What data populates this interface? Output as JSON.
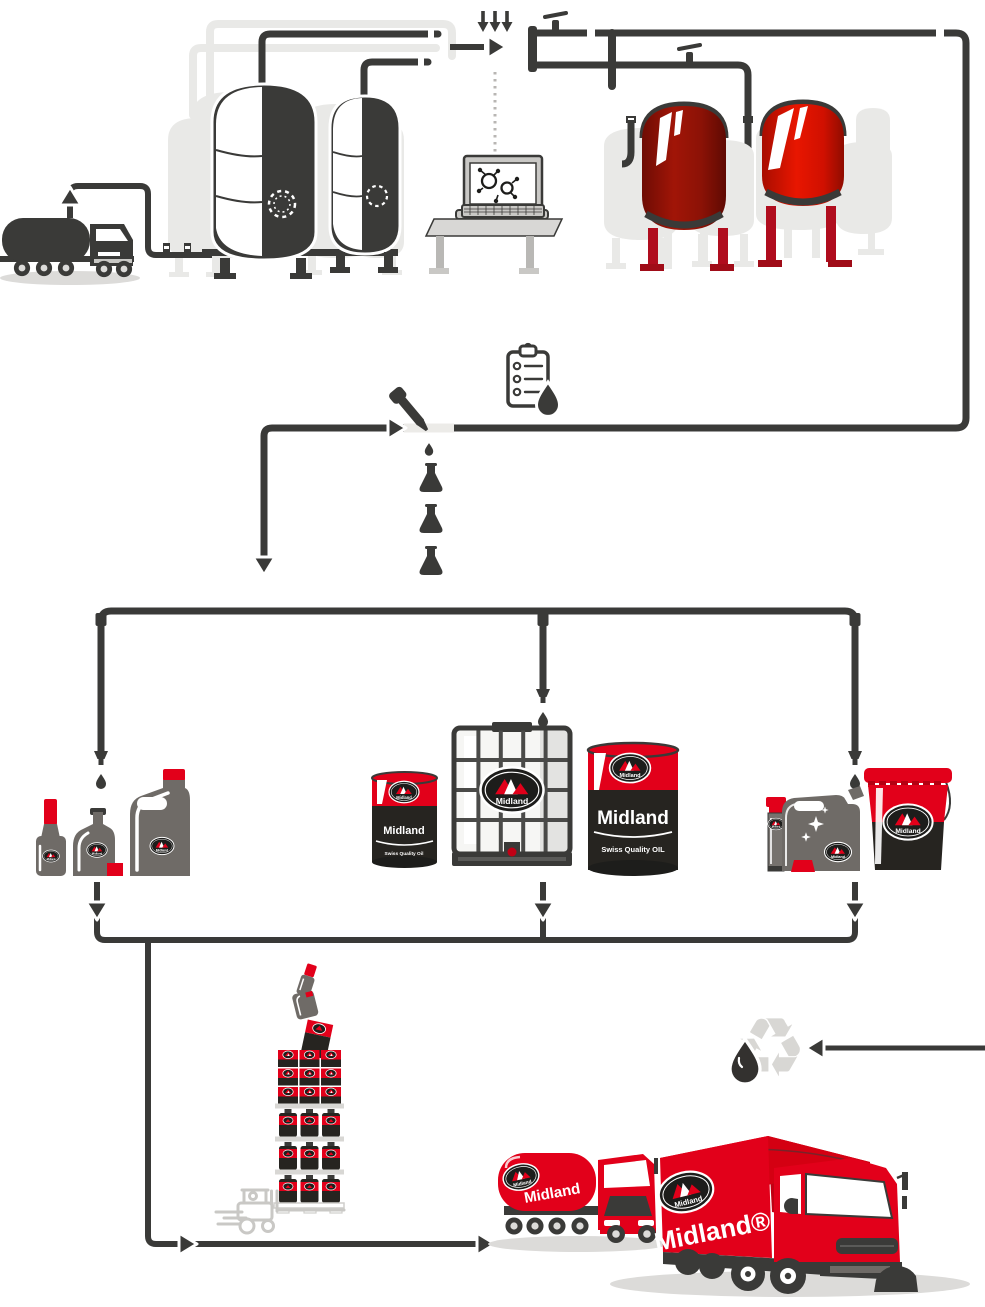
{
  "page": {
    "width": 985,
    "height": 1307,
    "background": "#ffffff"
  },
  "brand": {
    "logo_text": "Midland",
    "tagline": "Swiss Quality Oil"
  },
  "colors": {
    "red": "#e2001a",
    "dark_red": "#8f1406",
    "charcoal": "#3a3a38",
    "label_black": "#262420",
    "light_gray": "#e9e9e7",
    "container_gray": "#6f6b67",
    "pale_gray": "#c9c8c5",
    "shadow_gray": "#dcdbd9"
  },
  "labels": {
    "drum_small_brand": "Midland",
    "drum_small_tagline": "Swiss Quality Oil",
    "drum_large_brand": "Midland",
    "drum_large_tagline": "Swiss Quality OIL",
    "tanker_truck_brand": "Midland",
    "box_truck_brand": "Midland®"
  },
  "icons": {
    "recycle_glyph": "♻",
    "names": [
      "up-arrow-icon",
      "additive-arrows-icon",
      "flow-arrow-icon",
      "molecule-icon",
      "laptop-icon",
      "clipboard-checklist-icon",
      "oil-drop-icon",
      "pipette-icon",
      "flask-icon",
      "down-arrow-icon",
      "nozzle-icon",
      "valve-icon",
      "recycle-icon",
      "forklift-icon",
      "sparkle-icon",
      "midland-logo"
    ]
  }
}
